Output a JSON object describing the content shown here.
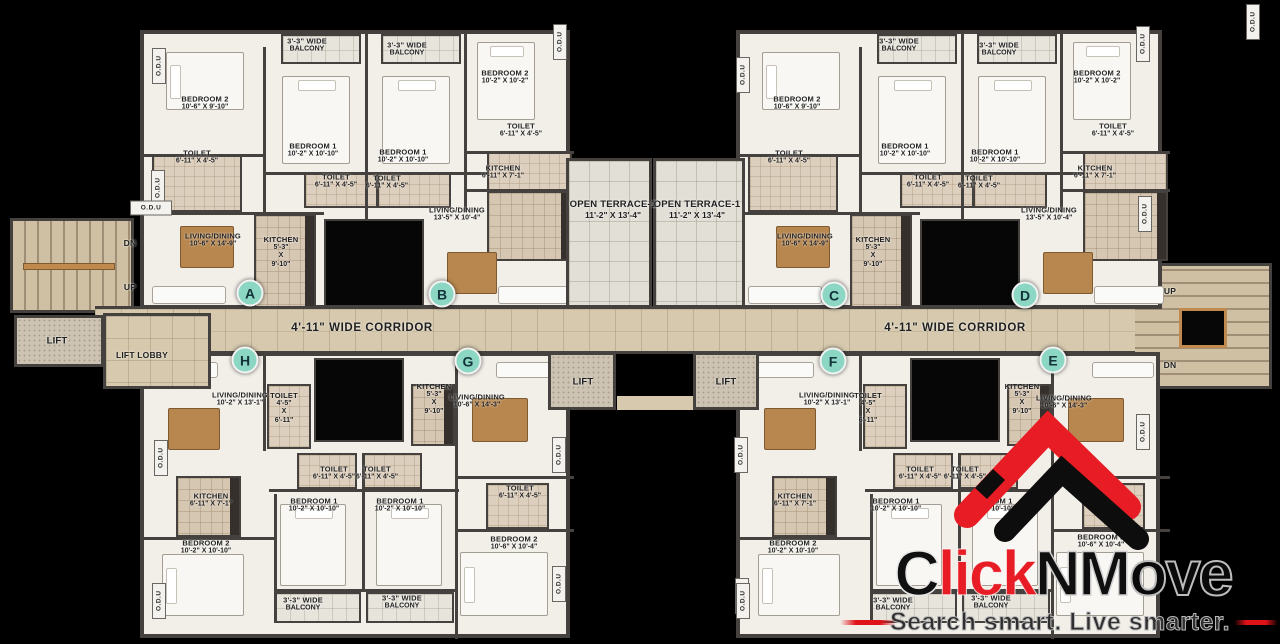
{
  "branding": {
    "name": "ClickNMove",
    "part1": "C",
    "part2": "lick",
    "part3": "NM",
    "part4": "ove",
    "tagline": "Search smart. Live smarter.",
    "colors": {
      "red": "#e81c24",
      "black": "#0f0f0f"
    }
  },
  "plan": {
    "odu_label": "O.D.U",
    "corridor_label": "4'-11\" WIDE CORRIDOR",
    "unit_colors": {
      "marker_fill": "#8bd7c3",
      "marker_text": "#14323a"
    },
    "units": [
      {
        "id": "A",
        "rooms": [
          "BEDROOM 1 10'-2\" X 10'-10\"",
          "BEDROOM 2 10'-6\" X 9'-10\"",
          "LIVING/DINING 10'-6\" X 14'-9\"",
          "KITCHEN 5'-3\" X 9'-10\"",
          "TOILET 6'-11\" X 4'-5\"",
          "TOILET 6'-11\" X 4'-5\"",
          "3'-3\" WIDE BALCONY"
        ]
      },
      {
        "id": "B",
        "rooms": [
          "BEDROOM 1 10'-2\" X 10'-10\"",
          "BEDROOM 2 10'-2\" X 10'-2\"",
          "LIVING/DINING 13'-5\" X 10'-4\"",
          "KITCHEN 6'-11\" X 7'-1\"",
          "TOILET 6'-11\" X 4'-5\"",
          "TOILET 6'-11\" X 4'-5\"",
          "3'-3\" WIDE BALCONY"
        ]
      },
      {
        "id": "C",
        "rooms": [
          "BEDROOM 1 10'-2\" X 10'-10\"",
          "BEDROOM 2 10'-6\" X 9'-10\"",
          "LIVING/DINING 10'-6\" X 14'-9\"",
          "KITCHEN 5'-3\" X 9'-10\"",
          "TOILET 6'-11\" X 4'-5\"",
          "TOILET 6'-11\" X 4'-5\"",
          "3'-3\" WIDE BALCONY"
        ]
      },
      {
        "id": "D",
        "rooms": [
          "BEDROOM 1 10'-2\" X 10'-10\"",
          "BEDROOM 2 10'-2\" X 10'-2\"",
          "LIVING/DINING 13'-5\" X 10'-4\"",
          "KITCHEN 6'-11\" X 7'-1\"",
          "TOILET 6'-11\" X 4'-5\"",
          "TOILET 6'-11\" X 4'-5\"",
          "3'-3\" WIDE BALCONY"
        ]
      },
      {
        "id": "E",
        "rooms": [
          "BEDROOM 1 10'-2\" X 10'-10\"",
          "BEDROOM 2 10'-6\" X 10'-4\"",
          "LIVING/DINING 10'-6\" X 14'-3\"",
          "KITCHEN 5'-3\" X 9'-10\"",
          "TOILET 6'-11\" X 4'-5\"",
          "TOILET 6'-11\" X 4'-5\"",
          "3'-3\" WIDE BALCONY"
        ]
      },
      {
        "id": "F",
        "rooms": [
          "BEDROOM 1 10'-2\" X 10'-10\"",
          "BEDROOM 2 10'-2\" X 10'-10\"",
          "LIVING/DINING 10'-2\" X 13'-1\"",
          "KITCHEN 6'-11\" X 7'-1\"",
          "TOILET 4'-5\" X 6'-11\"",
          "TOILET 6'-11\" X 4'-5\"",
          "3'-3\" WIDE BALCONY"
        ]
      },
      {
        "id": "G",
        "rooms": [
          "BEDROOM 1 10'-2\" X 10'-10\"",
          "BEDROOM 2 10'-6\" X 10'-4\"",
          "LIVING/DINING 10'-6\" X 14'-3\"",
          "KITCHEN 5'-3\" X 9'-10\"",
          "TOILET 6'-11\" X 4'-5\"",
          "TOILET 6'-11\" X 4'-5\"",
          "3'-3\" WIDE BALCONY"
        ]
      },
      {
        "id": "H",
        "rooms": [
          "BEDROOM 1 10'-2\" X 10'-10\"",
          "BEDROOM 2 10'-2\" X 10'-10\"",
          "LIVING/DINING 10'-2\" X 13'-1\"",
          "KITCHEN 6'-11\" X 7'-1\"",
          "TOILET 4'-5\" X 6'-11\"",
          "TOILET 6'-11\" X 4'-5\"",
          "3'-3\" WIDE BALCONY"
        ]
      }
    ]
  },
  "unit_markers": [
    {
      "id": "A",
      "x": 250,
      "y": 293
    },
    {
      "id": "B",
      "x": 442,
      "y": 294
    },
    {
      "id": "C",
      "x": 834,
      "y": 295
    },
    {
      "id": "D",
      "x": 1025,
      "y": 295
    },
    {
      "id": "H",
      "x": 245,
      "y": 360
    },
    {
      "id": "G",
      "x": 468,
      "y": 361
    },
    {
      "id": "F",
      "x": 833,
      "y": 361
    },
    {
      "id": "E",
      "x": 1053,
      "y": 360
    }
  ],
  "labels": [
    {
      "l": [
        "BEDROOM 2",
        "10'-6\" X 9'-10\""
      ],
      "x": 205,
      "y": 103
    },
    {
      "l": [
        "TOILET",
        "6'-11\" X 4'-5\""
      ],
      "x": 197,
      "y": 157
    },
    {
      "l": [
        "LIVING/DINING",
        "10'-6\" X 14'-9\""
      ],
      "x": 213,
      "y": 240
    },
    {
      "l": [
        "KITCHEN",
        "5'-3\"",
        "X",
        "9'-10\""
      ],
      "x": 281,
      "y": 252
    },
    {
      "l": [
        "BEDROOM 1",
        "10'-2\" X 10'-10\""
      ],
      "x": 313,
      "y": 150
    },
    {
      "l": [
        "TOILET",
        "6'-11\" X 4'-5\""
      ],
      "x": 336,
      "y": 181
    },
    {
      "l": [
        "3'-3\" WIDE",
        "BALCONY"
      ],
      "x": 307,
      "y": 45
    },
    {
      "l": [
        "3'-3\" WIDE",
        "BALCONY"
      ],
      "x": 407,
      "y": 49
    },
    {
      "l": [
        "BEDROOM 1",
        "10'-2\" X 10'-10\""
      ],
      "x": 403,
      "y": 156
    },
    {
      "l": [
        "TOILET",
        "6'-11\" X 4'-5\""
      ],
      "x": 387,
      "y": 182
    },
    {
      "l": [
        "BEDROOM 2",
        "10'-2\" X 10'-2\""
      ],
      "x": 505,
      "y": 77
    },
    {
      "l": [
        "TOILET",
        "6'-11\" X 4'-5\""
      ],
      "x": 521,
      "y": 130
    },
    {
      "l": [
        "KITCHEN",
        "6'-11\" X 7'-1\""
      ],
      "x": 503,
      "y": 172
    },
    {
      "l": [
        "LIVING/DINING",
        "13'-5\" X 10'-4\""
      ],
      "x": 457,
      "y": 214
    },
    {
      "l": [
        "BEDROOM 2",
        "10'-6\" X 9'-10\""
      ],
      "x": 797,
      "y": 103
    },
    {
      "l": [
        "TOILET",
        "6'-11\" X 4'-5\""
      ],
      "x": 789,
      "y": 157
    },
    {
      "l": [
        "LIVING/DINING",
        "10'-6\" X 14'-9\""
      ],
      "x": 805,
      "y": 240
    },
    {
      "l": [
        "KITCHEN",
        "5'-3\"",
        "X",
        "9'-10\""
      ],
      "x": 873,
      "y": 252
    },
    {
      "l": [
        "BEDROOM 1",
        "10'-2\" X 10'-10\""
      ],
      "x": 905,
      "y": 150
    },
    {
      "l": [
        "TOILET",
        "6'-11\" X 4'-5\""
      ],
      "x": 928,
      "y": 181
    },
    {
      "l": [
        "3'-3\" WIDE",
        "BALCONY"
      ],
      "x": 899,
      "y": 45
    },
    {
      "l": [
        "3'-3\" WIDE",
        "BALCONY"
      ],
      "x": 999,
      "y": 49
    },
    {
      "l": [
        "BEDROOM 1",
        "10'-2\" X 10'-10\""
      ],
      "x": 995,
      "y": 156
    },
    {
      "l": [
        "TOILET",
        "6'-11\" X 4'-5\""
      ],
      "x": 979,
      "y": 182
    },
    {
      "l": [
        "BEDROOM 2",
        "10'-2\" X 10'-2\""
      ],
      "x": 1097,
      "y": 77
    },
    {
      "l": [
        "TOILET",
        "6'-11\" X 4'-5\""
      ],
      "x": 1113,
      "y": 130
    },
    {
      "l": [
        "KITCHEN",
        "6'-11\" X 7'-1\""
      ],
      "x": 1095,
      "y": 172
    },
    {
      "l": [
        "LIVING/DINING",
        "13'-5\" X 10'-4\""
      ],
      "x": 1049,
      "y": 214
    },
    {
      "l": [
        "OPEN TERRACE-1",
        "11'-2\" X 13'-4\""
      ],
      "x": 613,
      "y": 210,
      "k": "m"
    },
    {
      "l": [
        "OPEN TERRACE-1",
        "11'-2\" X 13'-4\""
      ],
      "x": 697,
      "y": 210,
      "k": "m"
    },
    {
      "l": [
        "4'-11\" WIDE CORRIDOR"
      ],
      "x": 362,
      "y": 329,
      "k": "c"
    },
    {
      "l": [
        "4'-11\" WIDE CORRIDOR"
      ],
      "x": 955,
      "y": 329,
      "k": "c"
    },
    {
      "l": [
        "LIFT"
      ],
      "x": 57,
      "y": 341,
      "k": "m"
    },
    {
      "l": [
        "LIFT LOBBY"
      ],
      "x": 142,
      "y": 355,
      "k": "t"
    },
    {
      "l": [
        "DN"
      ],
      "x": 130,
      "y": 243,
      "k": "t"
    },
    {
      "l": [
        "UP"
      ],
      "x": 130,
      "y": 287,
      "k": "t"
    },
    {
      "l": [
        "UP"
      ],
      "x": 1170,
      "y": 291,
      "k": "t"
    },
    {
      "l": [
        "DN"
      ],
      "x": 1170,
      "y": 365,
      "k": "t"
    },
    {
      "l": [
        "LIFT"
      ],
      "x": 583,
      "y": 382,
      "k": "m"
    },
    {
      "l": [
        "LIFT"
      ],
      "x": 726,
      "y": 382,
      "k": "m"
    },
    {
      "l": [
        "LIVING/DINING",
        "10'-2\" X 13'-1\""
      ],
      "x": 240,
      "y": 399
    },
    {
      "l": [
        "TOILET",
        "4'-5\"",
        "X",
        "6'-11\""
      ],
      "x": 284,
      "y": 408
    },
    {
      "l": [
        "KITCHEN",
        "6'-11\" X 7'-1\""
      ],
      "x": 211,
      "y": 500
    },
    {
      "l": [
        "BEDROOM 2",
        "10'-2\" X 10'-10\""
      ],
      "x": 206,
      "y": 547
    },
    {
      "l": [
        "BEDROOM 1",
        "10'-2\" X 10'-10\""
      ],
      "x": 314,
      "y": 505
    },
    {
      "l": [
        "TOILET",
        "6'-11\" X 4'-5\""
      ],
      "x": 334,
      "y": 473
    },
    {
      "l": [
        "TOILET",
        "6'-11\" X 4'-5\""
      ],
      "x": 377,
      "y": 473
    },
    {
      "l": [
        "BEDROOM 1",
        "10'-2\" X 10'-10\""
      ],
      "x": 400,
      "y": 505
    },
    {
      "l": [
        "KITCHEN",
        "5'-3\"",
        "X",
        "9'-10\""
      ],
      "x": 434,
      "y": 399
    },
    {
      "l": [
        "LIVING/DINING",
        "10'-6\" X 14'-3\""
      ],
      "x": 477,
      "y": 401
    },
    {
      "l": [
        "TOILET",
        "6'-11\" X 4'-5\""
      ],
      "x": 520,
      "y": 492
    },
    {
      "l": [
        "BEDROOM 2",
        "10'-6\" X 10'-4\""
      ],
      "x": 514,
      "y": 543
    },
    {
      "l": [
        "3'-3\" WIDE",
        "BALCONY"
      ],
      "x": 303,
      "y": 604
    },
    {
      "l": [
        "3'-3\" WIDE",
        "BALCONY"
      ],
      "x": 402,
      "y": 602
    },
    {
      "l": [
        "LIVING/DINING",
        "10'-2\" X 13'-1\""
      ],
      "x": 827,
      "y": 399
    },
    {
      "l": [
        "TOILET",
        "4'-5\"",
        "X",
        "6'-11\""
      ],
      "x": 868,
      "y": 408
    },
    {
      "l": [
        "KITCHEN",
        "6'-11\" X 7'-1\""
      ],
      "x": 795,
      "y": 500
    },
    {
      "l": [
        "BEDROOM 2",
        "10'-2\" X 10'-10\""
      ],
      "x": 793,
      "y": 547
    },
    {
      "l": [
        "BEDROOM 1",
        "10'-2\" X 10'-10\""
      ],
      "x": 896,
      "y": 505
    },
    {
      "l": [
        "TOILET",
        "6'-11\" X 4'-5\""
      ],
      "x": 920,
      "y": 473
    },
    {
      "l": [
        "TOILET",
        "6'-11\" X 4'-5\""
      ],
      "x": 965,
      "y": 473
    },
    {
      "l": [
        "BEDROOM 1",
        "10'-2\" X 10'-10\""
      ],
      "x": 989,
      "y": 505
    },
    {
      "l": [
        "KITCHEN",
        "5'-3\"",
        "X",
        "9'-10\""
      ],
      "x": 1022,
      "y": 399
    },
    {
      "l": [
        "LIVING/DINING",
        "10'-6\" X 14'-3\""
      ],
      "x": 1064,
      "y": 402
    },
    {
      "l": [
        "TOILET",
        "6'-11\" X 4'-5\""
      ],
      "x": 1109,
      "y": 492
    },
    {
      "l": [
        "BEDROOM 2",
        "10'-6\" X 10'-4\""
      ],
      "x": 1101,
      "y": 541
    },
    {
      "l": [
        "3'-3\" WIDE",
        "BALCONY"
      ],
      "x": 893,
      "y": 604
    },
    {
      "l": [
        "3'-3\" WIDE",
        "BALCONY"
      ],
      "x": 991,
      "y": 602
    }
  ],
  "odu_markers_vertical": [
    {
      "x": 159,
      "y": 66
    },
    {
      "x": 158,
      "y": 188
    },
    {
      "x": 560,
      "y": 42
    },
    {
      "x": 743,
      "y": 75
    },
    {
      "x": 1143,
      "y": 44
    },
    {
      "x": 1145,
      "y": 214
    },
    {
      "x": 1253,
      "y": 22
    },
    {
      "x": 161,
      "y": 458
    },
    {
      "x": 159,
      "y": 601
    },
    {
      "x": 559,
      "y": 455
    },
    {
      "x": 559,
      "y": 584
    },
    {
      "x": 741,
      "y": 455
    },
    {
      "x": 742,
      "y": 596
    },
    {
      "x": 1143,
      "y": 432
    },
    {
      "x": 743,
      "y": 601
    }
  ],
  "odu_markers_horizontal": [
    {
      "x": 151,
      "y": 208
    }
  ]
}
